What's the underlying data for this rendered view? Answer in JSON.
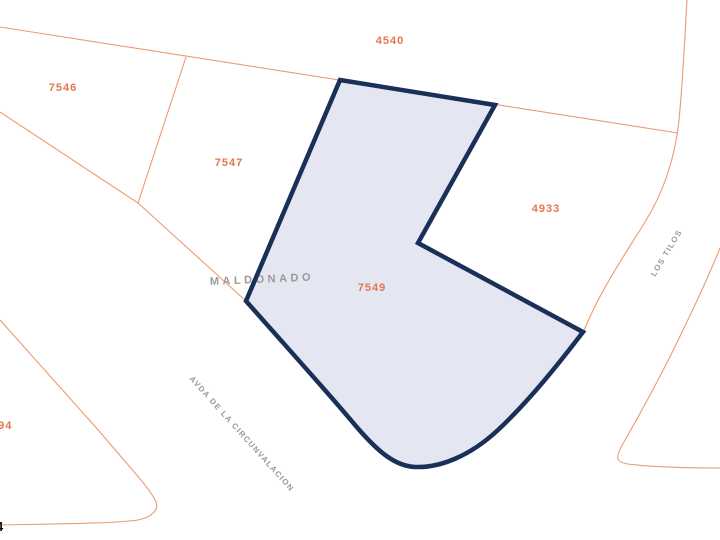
{
  "map": {
    "type": "cadastral-parcel-map",
    "parcel_labels": {
      "n4540": "4540",
      "n7546": "7546",
      "n7547": "7547",
      "n4933": "4933",
      "n7549": "7549",
      "n294": "294"
    },
    "street_labels": {
      "maldonado": "MALDONADO",
      "circunvalacion": "AVDA DE LA CIRCUNVALACION",
      "los_tilos": "LOS TILOS"
    },
    "corner_label": "4",
    "selected_parcel": {
      "id": "7549",
      "fill_color": "#e4e7f1",
      "border_color": "#1a3058"
    },
    "colors": {
      "background": "#ffffff",
      "boundary_line": "#eb9b72",
      "parcel_label_text": "#e4764f",
      "street_label_text": "#9a9a9a",
      "corner_label_text": "#111111"
    }
  }
}
